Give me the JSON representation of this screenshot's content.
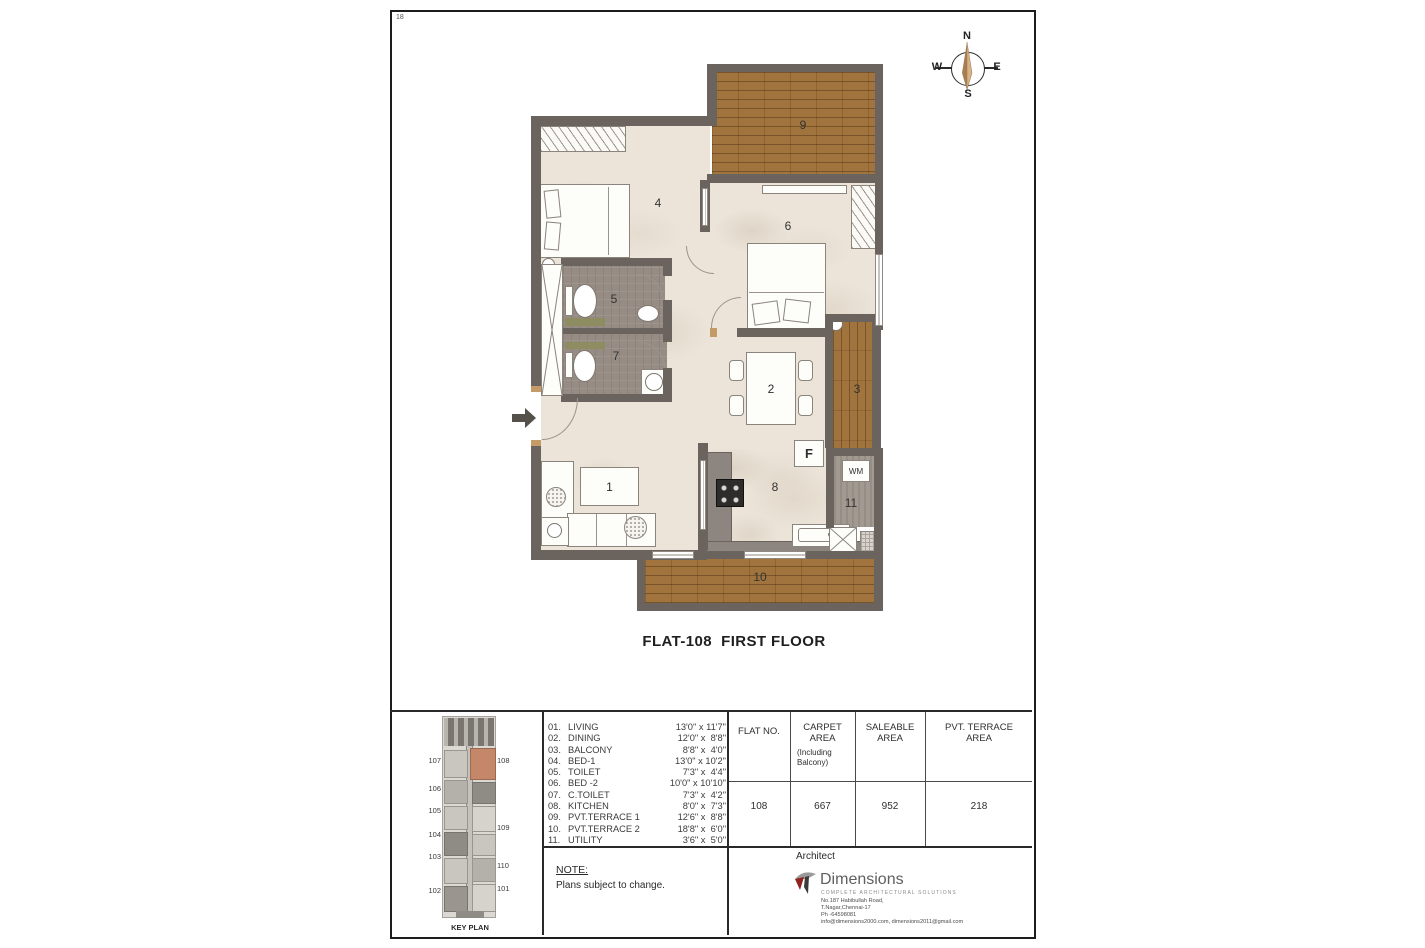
{
  "sheet": {
    "number": "18"
  },
  "compass": {
    "north": "N",
    "south": "S",
    "east": "E",
    "west": "W"
  },
  "plan": {
    "title": "FLAT-108  FIRST FLOOR",
    "rooms": {
      "living": "1",
      "dining": "2",
      "balcony": "3",
      "bed1": "4",
      "toilet": "5",
      "bed2": "6",
      "ctoilet": "7",
      "kitchen": "8",
      "terrace1": "9",
      "terrace2": "10",
      "utility": "11"
    },
    "appliances": {
      "fridge": "F",
      "washing_machine": "WM"
    }
  },
  "legend": {
    "items": [
      {
        "no": "01.",
        "name": "LIVING",
        "dim": "13'0\" x 11'7\""
      },
      {
        "no": "02.",
        "name": "DINING",
        "dim": "12'0\" x  8'8\""
      },
      {
        "no": "03.",
        "name": "BALCONY",
        "dim": "8'8\" x  4'0\""
      },
      {
        "no": "04.",
        "name": "BED-1",
        "dim": "13'0\" x 10'2\""
      },
      {
        "no": "05.",
        "name": "TOILET",
        "dim": "7'3\" x  4'4\""
      },
      {
        "no": "06.",
        "name": "BED -2",
        "dim": "10'0\" x 10'10\""
      },
      {
        "no": "07.",
        "name": "C.TOILET",
        "dim": "7'3\" x  4'2\""
      },
      {
        "no": "08.",
        "name": "KITCHEN",
        "dim": "8'0\" x  7'3\""
      },
      {
        "no": "09.",
        "name": "PVT.TERRACE 1",
        "dim": "12'6\" x  8'8\""
      },
      {
        "no": "10.",
        "name": "PVT.TERRACE 2",
        "dim": "18'8\" x  6'0\""
      },
      {
        "no": "11.",
        "name": "UTILITY",
        "dim": "3'6\" x  5'0\""
      }
    ]
  },
  "table": {
    "col1_header": "FLAT NO.",
    "col2_header": "CARPET AREA",
    "col2_sub": "(Including Balcony)",
    "col3_header": "SALEABLE AREA",
    "col4_header": "PVT. TERRACE AREA",
    "row": {
      "flat_no": "108",
      "carpet_area": "667",
      "saleable_area": "952",
      "pvt_terrace_area": "218"
    }
  },
  "note": {
    "title": "NOTE:",
    "text": "Plans subject to change."
  },
  "architect": {
    "label": "Architect",
    "firm": "Dimensions",
    "tagline": "COMPLETE ARCHITECTURAL SOLUTIONS",
    "address1": "No.187 Habibullah Road,",
    "address2": "T.Nagar,Chennai-17",
    "phone": "Ph -64598081",
    "email": "info@dimensions2000.com, dimensions2011@gmail.com"
  },
  "key_plan": {
    "label": "KEY PLAN",
    "left_units": [
      "107",
      "106",
      "105",
      "104",
      "103",
      "102"
    ],
    "right_units": [
      "108",
      "109",
      "110",
      "101"
    ]
  },
  "colors": {
    "wall": "#6b645e",
    "wood": "#a1743e",
    "highlight_unit": "#c4876a",
    "logo_red": "#8e2320"
  }
}
